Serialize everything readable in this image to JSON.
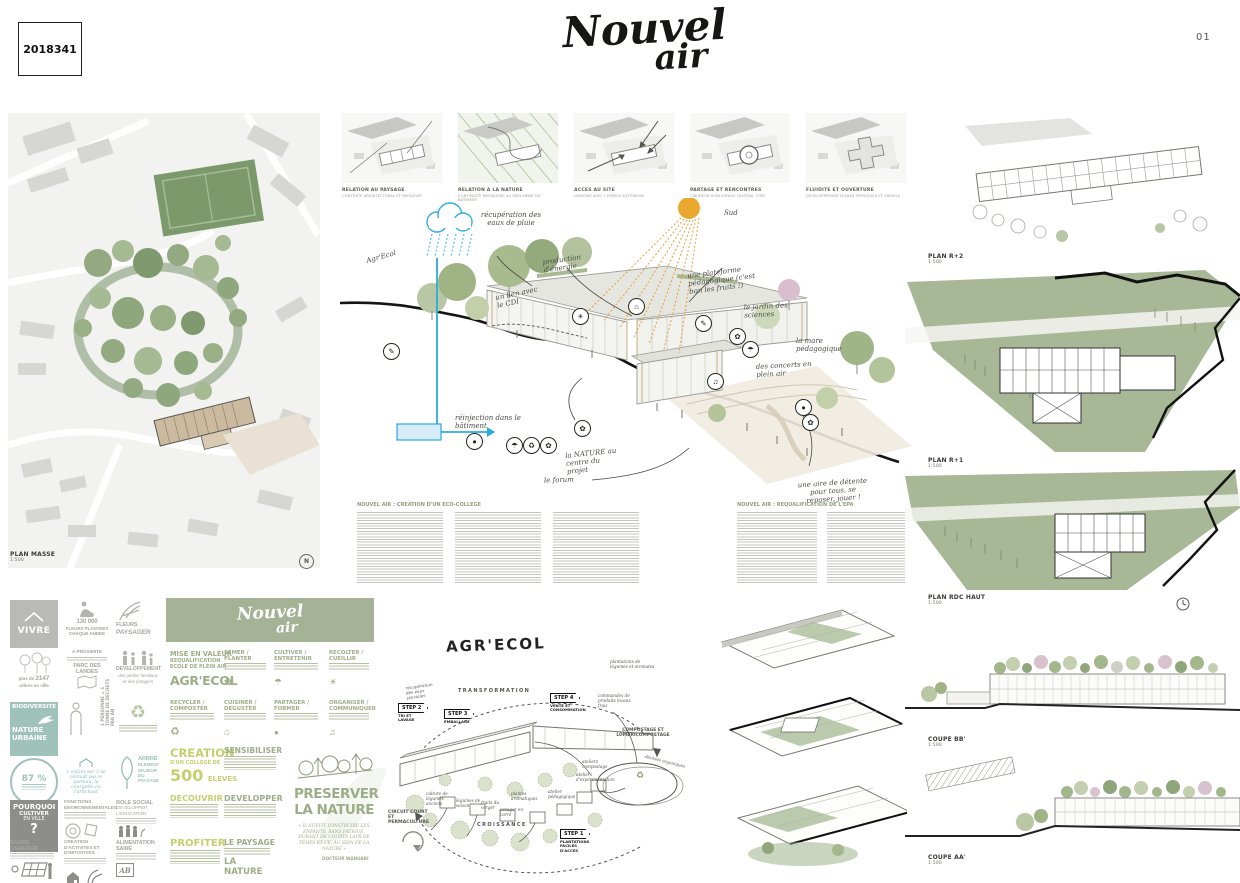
{
  "board": {
    "competition_number": "2018341",
    "page_number": "01"
  },
  "logo": {
    "line1": "Nouvel",
    "line2": "air"
  },
  "icons": {
    "recycle": "♻",
    "flower": "✿",
    "music": "♫",
    "house": "⌂",
    "sun": "☀",
    "pencil": "✎",
    "umbrella": "☂",
    "dot": "●",
    "north": "N"
  },
  "site_plan": {
    "label": "PLAN MASSE",
    "scale": "1:500"
  },
  "concepts": [
    {
      "title": "RELATION AU PAYSAGE",
      "subtitle": "CONTEXTE ARCHITECTURAL ET PAYSAGER"
    },
    {
      "title": "RELATION A LA NATURE",
      "subtitle": "CONTINUITE PAYSAGERE AU SEIN MEME DU BATIMENT"
    },
    {
      "title": "ACCES AU SITE",
      "subtitle": "LIAISONS AVEC L'ESPACE EXTERIEUR"
    },
    {
      "title": "PARTAGE ET RENCONTRES",
      "subtitle": "CREATION D'UN ESPACE CENTRAL FORT"
    },
    {
      "title": "FLUIDITE ET OUVERTURE",
      "subtitle": "DEVELOPPEMENT D'AXES PHYSIQUES ET VISUELS"
    }
  ],
  "axon": {
    "annotations": {
      "rain": "récupération des eaux de pluie",
      "agrecol": "Agr'Ecol",
      "energy": "production d'énergie",
      "sun": "Sud",
      "cdi": "un lien avec le CDI",
      "platform": "une plateforme pédagogique (c'est bon les fruits !)",
      "garden": "le jardin des sciences",
      "pond": "la mare pédagogique",
      "concerts": "des concerts en plein air",
      "reinject": "réinjection dans le bâtiment",
      "nature": "la NATURE au centre du projet",
      "forum": "le forum",
      "rest": "une aire de détente pour tous, se reposer, jouer !"
    }
  },
  "texts": {
    "heading_left": "NOUVEL AIR : CREATION D'UN ECO-COLLEGE",
    "heading_right": "NOUVEL AIR : REQUALIFICATION DE L'EPA"
  },
  "plans": [
    {
      "label": "PLAN R+2",
      "scale": "1:500"
    },
    {
      "label": "PLAN R+1",
      "scale": "1:500"
    },
    {
      "label": "PLAN RDC HAUT",
      "scale": "1:500"
    }
  ],
  "coupes": [
    {
      "label": "COUPE BB'",
      "scale": "1:500"
    },
    {
      "label": "COUPE AA'",
      "scale": "1:500"
    }
  ],
  "stats": {
    "vivre": {
      "main": "VIVRE"
    },
    "fleurs": {
      "value": "130 000",
      "label": "FLEURS PLANTEES CHAQUE ANNEE"
    },
    "paysager": {
      "l1": "FLEURS",
      "l2": "PAYSAGER"
    },
    "arbres": {
      "pre": "plus de",
      "value": "2147",
      "label": "arbres en ville"
    },
    "proximite": {
      "l1": "A PROXIMITE",
      "l2": "PARC DES LANDES"
    },
    "developpement": {
      "l1": "DEVELOPPEMENT",
      "l2": "des jardins familiaux et des potagers"
    },
    "biodiversite": {
      "l1": "BIODIVERSITE",
      "l2": "NATURE",
      "l3": "URBAINE"
    },
    "dechets": {
      "label": "1 PERSONNE = 1 TONNE DE DECHETS PAR AN"
    },
    "pct": {
      "value": "87 %"
    },
    "enfant": {
      "label": "1 enfant sur 3 ne connaît pas le poireau, la courgette ou l'artichaut"
    },
    "arbre": {
      "l1": "ARBRE",
      "l2": "ELEMENT MAJEUR DU PAYSAGE"
    },
    "pourquoi": {
      "l1": "POURQUOI",
      "l2": "CULTIVER",
      "l3": "EN VILLE",
      "q": "?"
    },
    "fonctions": {
      "l1": "FONCTIONS ENVIRONNEMENTALES"
    },
    "role": {
      "l1": "ROLE SOCIAL",
      "l2": "DEVELOPPER L'EDUCATION"
    },
    "energie": {
      "l1": "BAISSE D'ENERGIE"
    },
    "activites": {
      "l1": "CREATION D'ACTIVITES ET D'INITIATIVES"
    },
    "alimentation": {
      "l1": "ALIMENTATION SAINE",
      "logo": "AB"
    }
  },
  "green_panel": {
    "intro_l1": "MISE EN VALEUR",
    "intro_l2": "REQUALIFICATION",
    "intro_l3": "ECOLE DE PLEIN AIR",
    "intro_big": "AGR'ECOL",
    "a1": "SEMER / PLANTER",
    "a2": "CULTIVER / ENTRETENIR",
    "a3": "RECOLTER / CUEILLIR",
    "a4": "RECYCLER / COMPOSTER",
    "a5": "CUISINER / DEGUSTER",
    "a6": "PARTAGER / FORMER",
    "a7": "ORGANISER / COMMUNIQUER",
    "creation_l1": "CREATION",
    "creation_l2": "D'UN COLLEGE DE",
    "creation_big": "500",
    "creation_l3": "ELEVES",
    "k1": "SENSIBILISER",
    "k2": "DECOUVRIR",
    "k3": "DEVELOPPER",
    "k4": "PROFITER",
    "paysage_l1": "LE PAYSAGE",
    "paysage_l2": "LA NATURE",
    "preserver_l1": "PRESERVER",
    "preserver_l2": "LA NATURE",
    "quote": "« IL SUFFIT D'INSTRUIRE LES ENFANTS, SANS FATIGUE, DURANT DE COURTS LAPS DE TEMPS ET CE, AU SEIN DE LA NATURE »",
    "author": "DOCTEUR WANGARI"
  },
  "agrecol": {
    "title": "AGR'ECOL",
    "arc_top": "TRANSFORMATION",
    "arc_bottom": "CROISSANCE",
    "step1_flag": "STEP 1",
    "step1_label": "PLANTATIONS FACILES D'ACCES",
    "step2_flag": "STEP 2",
    "step2_label": "TRI ET LAVAGE",
    "step3_flag": "STEP 3",
    "step3_label": "EMBALLAGE",
    "step4_flag": "STEP 4",
    "step4_label": "VENTE ET CONSOMMATION",
    "compost": "COMPOSTAGE ET LOMBRICOMPOSTAGE",
    "organics": "déchets organiques",
    "circuit": "CIRCUIT COURT ET PERMACULTURE",
    "n_eaux": "récupération des eaux pluviales",
    "n_anciens": "culture de légumes anciens",
    "n_saison": "légumes de saison",
    "n_verger": "fruits du verger",
    "n_potager": "potager en carré",
    "n_aroma": "plantes aromatiques",
    "n_atelier": "atelier pédagogique",
    "n_compost": "ateliers compostage",
    "n_expe": "ateliers d'expérimentation",
    "n_plantations": "plantations de légumes et aromates",
    "n_commandes": "commandes de produits locaux frais"
  },
  "colors": {
    "sage": "#a5b296",
    "chartreuse": "#c2d06e",
    "teal": "#8fbcb2",
    "sun": "#eaa82e",
    "blue": "#29abe2",
    "ink": "#161614"
  }
}
